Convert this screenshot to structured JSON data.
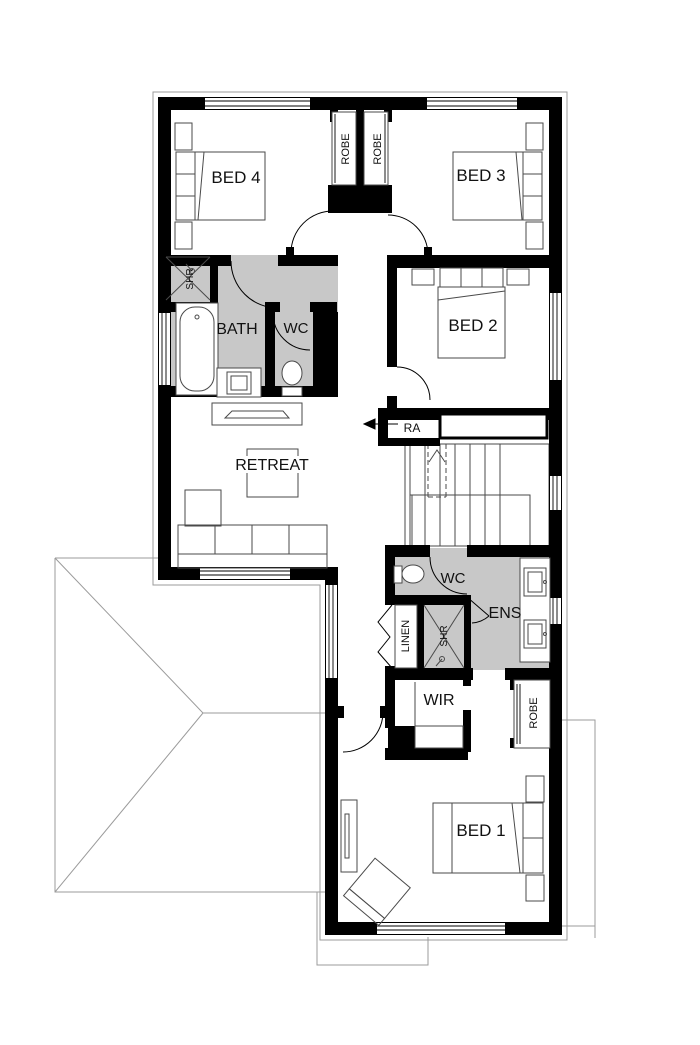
{
  "labels": {
    "bed4": "BED 4",
    "bed3": "BED 3",
    "bed2": "BED 2",
    "bed1": "BED 1",
    "bath": "BATH",
    "wc_bath": "WC",
    "retreat": "RETREAT",
    "ra": "RA",
    "wc_ens": "WC",
    "ens": "ENS",
    "wir": "WIR",
    "linen": "LINEN",
    "shr_bath": "SHR",
    "shr_ens": "SHR",
    "robe_left": "ROBE",
    "robe_right": "ROBE",
    "robe_bed1": "ROBE"
  },
  "colors": {
    "wall": "#000000",
    "wet_area": "#c8c8c8",
    "fixture_line": "#4a4a4a",
    "roof_line": "#9b9b9b"
  }
}
